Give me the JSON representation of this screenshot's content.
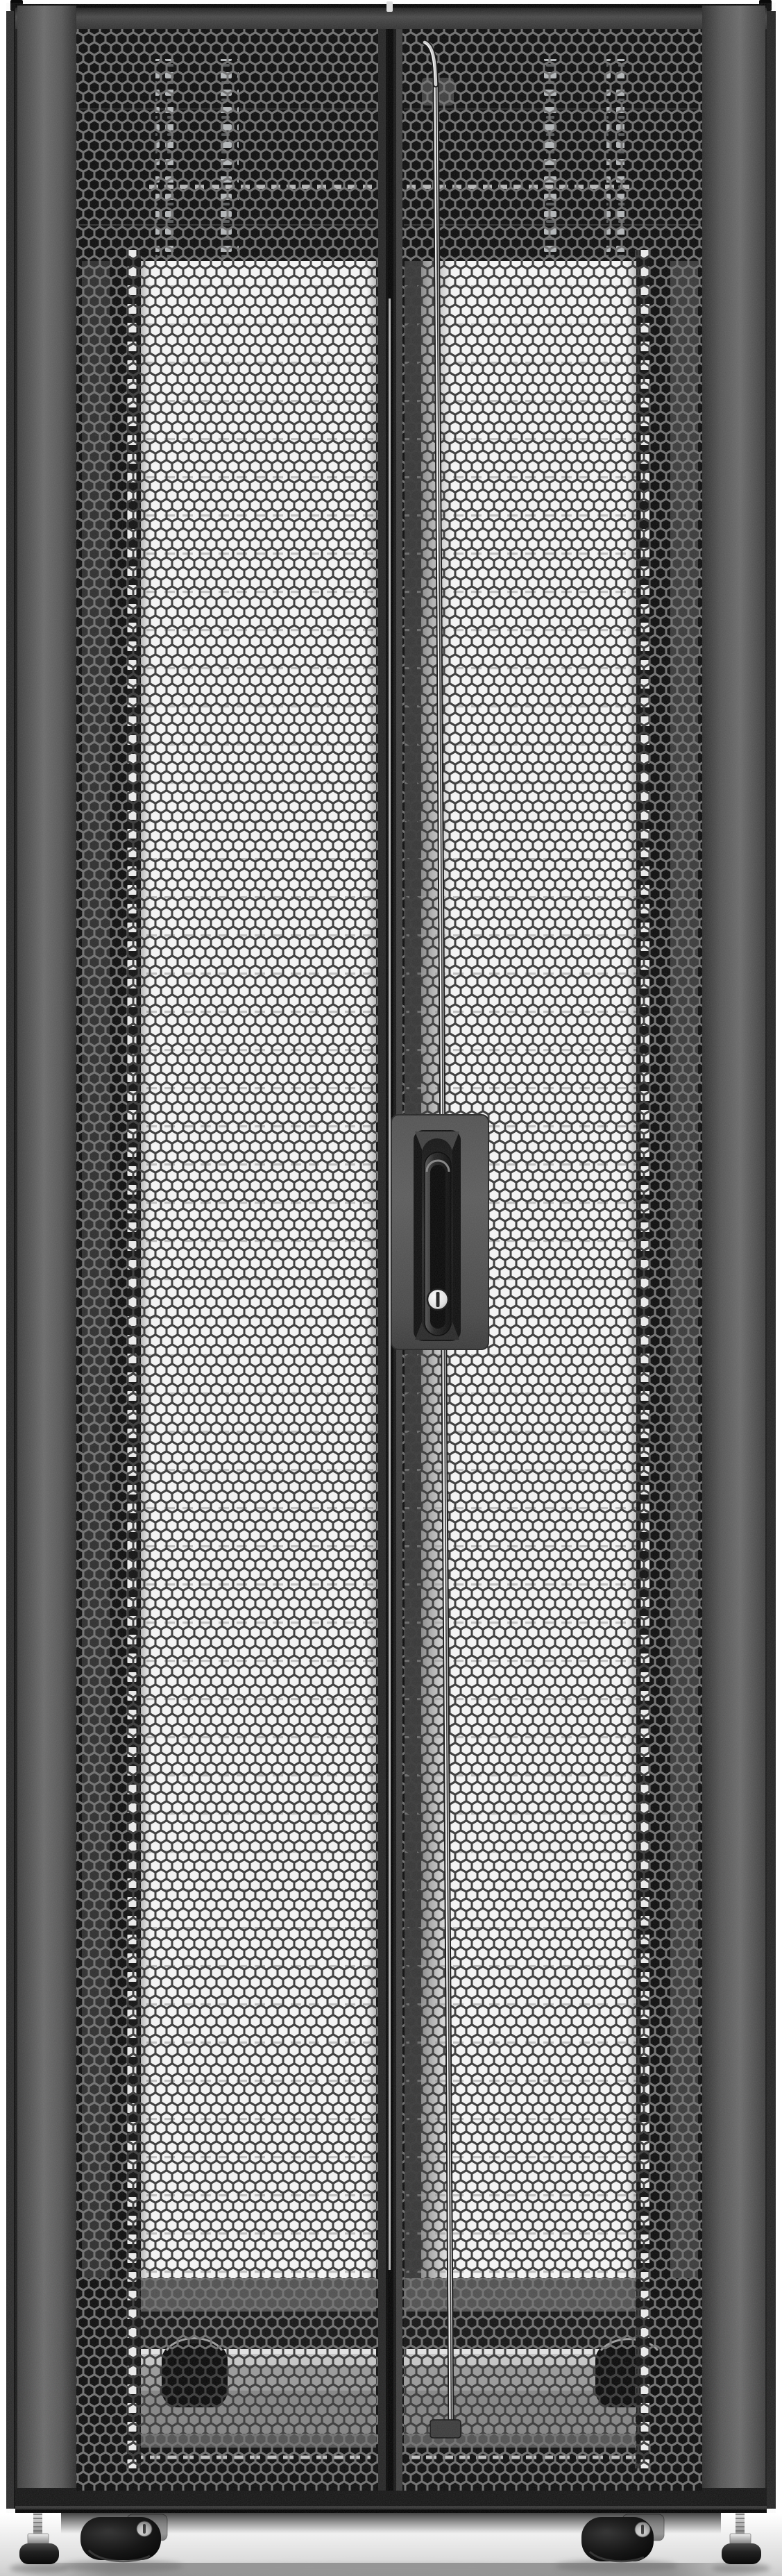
{
  "image": {
    "kind": "product-photo",
    "subject": "Black server rack enclosure, front view, closed",
    "background_color": "#ffffff"
  },
  "palette": {
    "frame_dark": "#191919",
    "interior_dark": "#0a0a0a",
    "stile_gray": "#5e5e5e",
    "mesh_web_light": "#6f6f6f",
    "mesh_web_dark": "#383838",
    "interior_white": "#f7f7f7",
    "metal_silver": "#d6d6d6",
    "wheel_black": "#0a0a0a",
    "floor_shadow": "#8e8e8e",
    "glow_white": "#ffffff"
  },
  "parts": {
    "left_door": "perforated hex-mesh door",
    "right_door": "perforated hex-mesh door with handle",
    "handle": "recessed swing handle",
    "key_lock": "round key cylinder with vertical slot",
    "lock_rod": "vertical lock rod with top hook and bottom bracket",
    "mounting_rails": "vertical rails with square cage-nut holes",
    "casters": [
      "front-left caster",
      "front-right caster"
    ],
    "leveling_feet": [
      "front-left leveling foot",
      "front-right leveling foot"
    ]
  }
}
